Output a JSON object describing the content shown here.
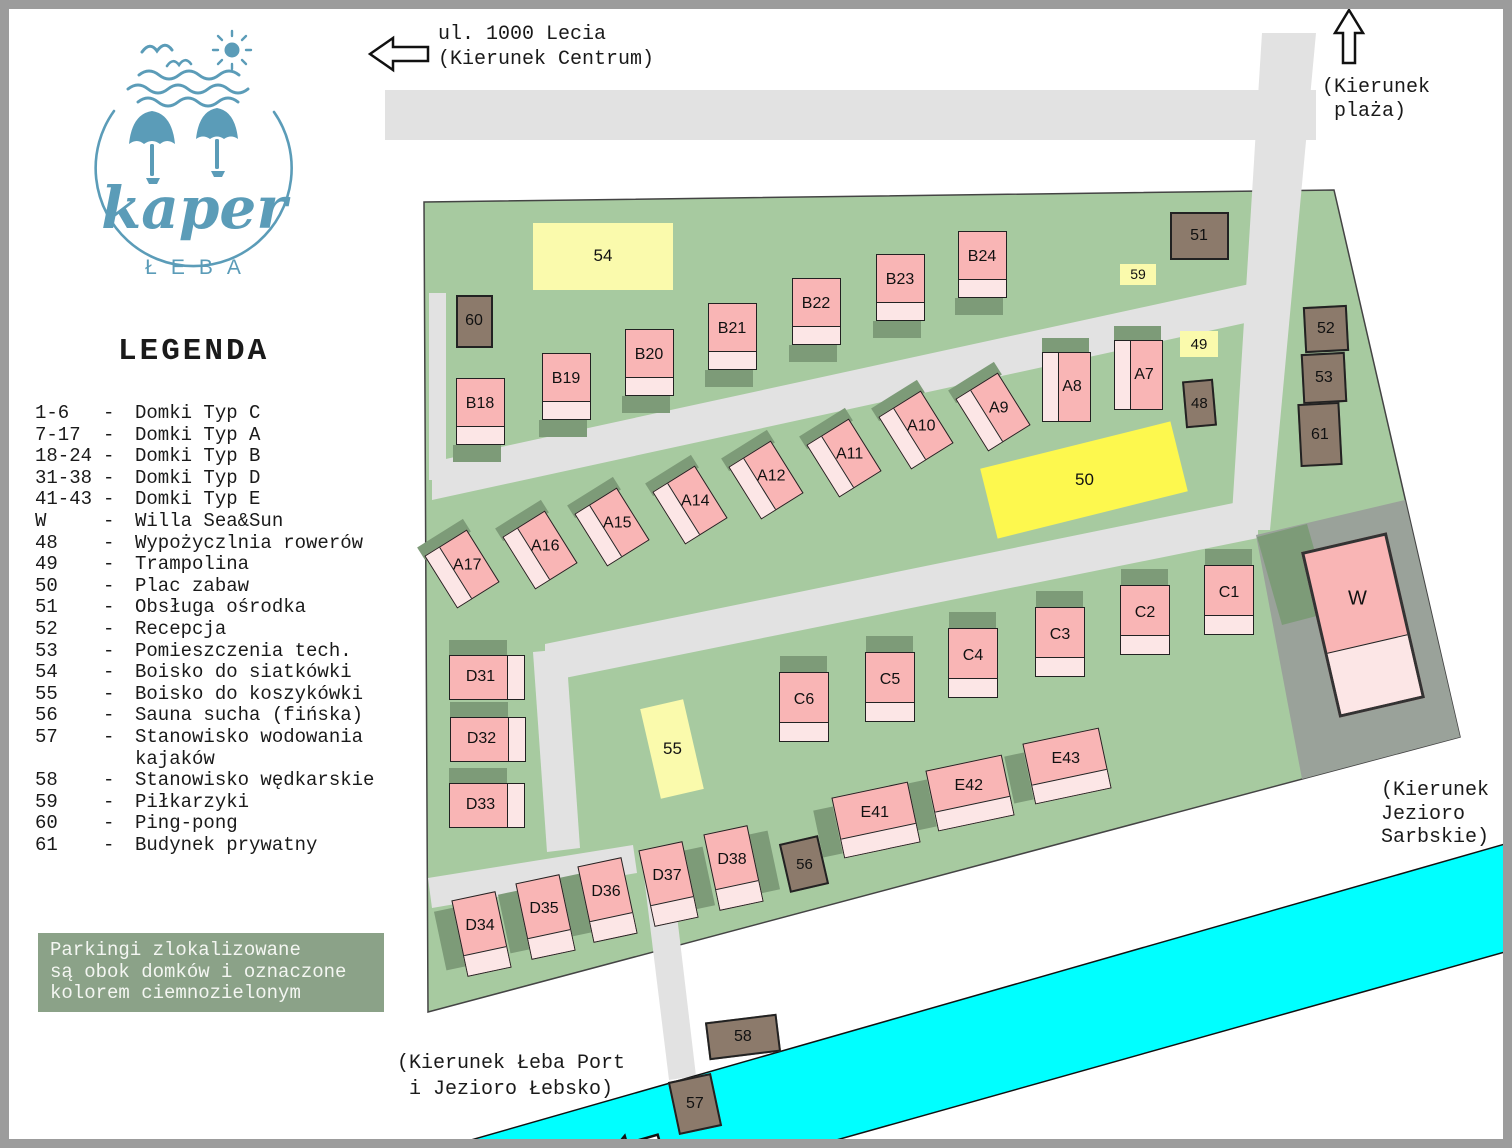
{
  "logo": {
    "brand": "kaper",
    "city": "ŁEBA"
  },
  "header": {
    "street": "ul. 1000 Lecia",
    "street_dir": "(Kierunek Centrum)"
  },
  "directions": {
    "beach": [
      "(Kierunek",
      "plaża)"
    ],
    "sarbskie": [
      "(Kierunek",
      "Jezioro",
      "Sarbskie)"
    ],
    "port": [
      "(Kierunek Łeba Port",
      "i Jezioro Łebsko)"
    ]
  },
  "legend": {
    "title": "LEGENDA",
    "items": [
      {
        "key": "1-6",
        "label": "Domki Typ C"
      },
      {
        "key": "7-17",
        "label": "Domki Typ A"
      },
      {
        "key": "18-24",
        "label": "Domki Typ B"
      },
      {
        "key": "31-38",
        "label": "Domki Typ D"
      },
      {
        "key": "41-43",
        "label": "Domki Typ E"
      },
      {
        "key": "W",
        "label": "Willa Sea&Sun"
      },
      {
        "key": "48",
        "label": "Wypożyczlnia rowerów"
      },
      {
        "key": "49",
        "label": "Trampolina"
      },
      {
        "key": "50",
        "label": "Plac zabaw"
      },
      {
        "key": "51",
        "label": "Obsługa ośrodka"
      },
      {
        "key": "52",
        "label": "Recepcja"
      },
      {
        "key": "53",
        "label": "Pomieszczenia tech."
      },
      {
        "key": "54",
        "label": "Boisko do siatkówki"
      },
      {
        "key": "55",
        "label": "Boisko do koszykówki"
      },
      {
        "key": "56",
        "label": "Sauna sucha (fińska)"
      },
      {
        "key": "57",
        "label": "Stanowisko wodowania kajaków"
      },
      {
        "key": "58",
        "label": "Stanowisko wędkarskie"
      },
      {
        "key": "59",
        "label": "Piłkarzyki"
      },
      {
        "key": "60",
        "label": "Ping-pong"
      },
      {
        "key": "61",
        "label": "Budynek prywatny"
      }
    ],
    "note_lines": [
      "Parkingi zlokalizowane",
      "są obok domków i oznaczone",
      "kolorem ciemnozielonym"
    ]
  },
  "map": {
    "cottages": [
      "B18",
      "B19",
      "B20",
      "B21",
      "B22",
      "B23",
      "B24",
      "A7",
      "A8",
      "A9",
      "A10",
      "A11",
      "A12",
      "A14",
      "A15",
      "A16",
      "A17",
      "C1",
      "C2",
      "C3",
      "C4",
      "C5",
      "C6",
      "D31",
      "D32",
      "D33",
      "D34",
      "D35",
      "D36",
      "D37",
      "D38",
      "E41",
      "E42",
      "E43",
      "W"
    ],
    "facilities": [
      "48",
      "49",
      "50",
      "51",
      "52",
      "53",
      "54",
      "55",
      "56",
      "57",
      "58",
      "59",
      "60",
      "61"
    ]
  },
  "colors": {
    "site_green": "#a7caa0",
    "parking_green": "#7d9b78",
    "note_green": "#8ba288",
    "road_gray": "#e2e2e2",
    "plot_gray": "#9aa29a",
    "cottage_pink": "#f9b5b5",
    "porch_pink": "#fce6e6",
    "brown": "#8c7a6b",
    "yellow_pale": "#fafaac",
    "yellow_bright": "#fdf84e",
    "river_cyan": "#00ffff",
    "logo_teal": "#5b9cb8"
  }
}
